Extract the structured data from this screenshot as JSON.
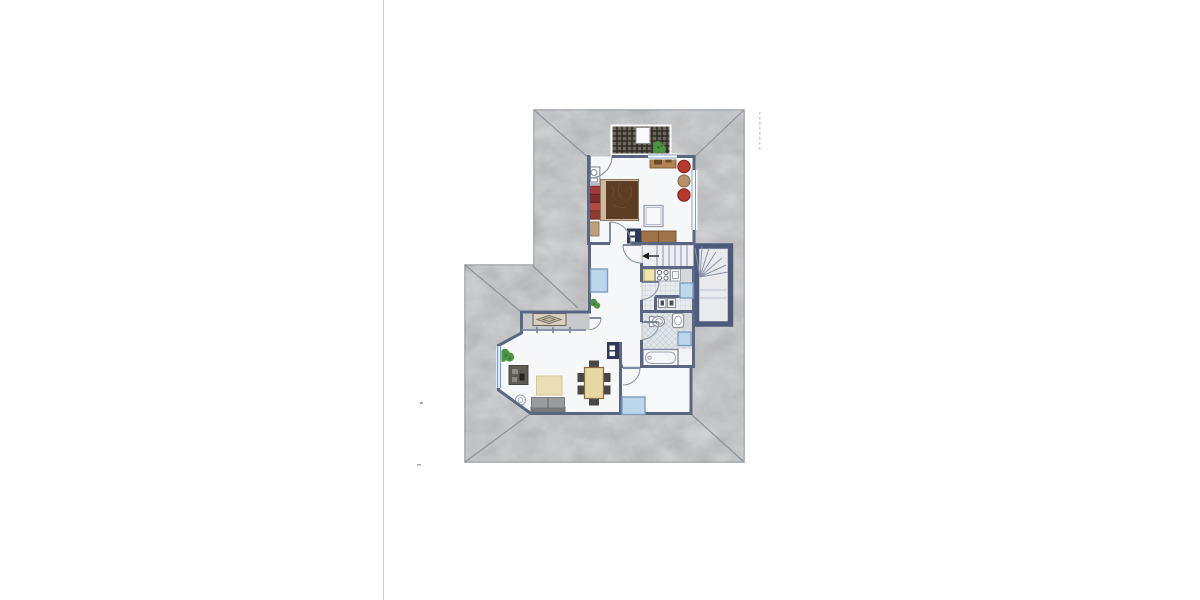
{
  "document": {
    "kind": "architectural floor plan drawing",
    "storey": "attic / roof level with hipped roof",
    "style": "hand-colored watercolor plan on white sheet",
    "visible_text": "none",
    "page_divider": "thin vertical fold line on left third of sheet"
  },
  "colors": {
    "paper": "#ffffff",
    "pageLine": "#cccccc",
    "roof": "#b5b7b9",
    "roofLine": "#8f939b",
    "roofEdge": "#9a9da3",
    "wall": "#5b6683",
    "wallThick": "#4d5a7a",
    "interior": "#f5f7f9",
    "stairFloor": "#edeff2",
    "tile": "#e7ebee",
    "tileLine": "#c3ccd6",
    "bathTile": "#e2e6ea",
    "counterGray": "#d3d8dd",
    "window": "#bcd6ec",
    "windowBorder": "#7f9cc2",
    "glazing": "#7e88a0",
    "arc": "#8a93a8",
    "tread": "#8992a8",
    "fixture": "#8b93a0",
    "balconyFloor": "#c7c9cb",
    "grating": "#6e665a",
    "gratingLine": "#2e2c28",
    "bedBrown": "#5d3d24",
    "bedFrame": "#cdb9a0",
    "wardrobeRed1": "#a33c3a",
    "wardrobeRed2": "#7e2d2d",
    "wardrobeRed3": "#b04a42",
    "wardrobeRed4": "#8e3a32",
    "chairRed": "#b8392e",
    "tableTan": "#b5906a",
    "woodDesk": "#b08354",
    "woodDresser": "#9e7347",
    "counterYellow": "#efe6ac",
    "rug": "#eadfb4",
    "sofa": "#989c9e",
    "sofaBack": "#74787a",
    "dining": "#e7d7a2",
    "chairDark": "#474745",
    "tvCabinet": "#5f5b55",
    "sideboard": "#d6d0c0",
    "plant": "#4c9440",
    "chimney": "#2f3a58",
    "arrowBlack": "#1c1c1c"
  },
  "rooms": [
    {
      "name": "roof terrace",
      "features": [
        "dark wooden grating deck",
        "small white table",
        "potted plant"
      ]
    },
    {
      "name": "bedroom",
      "furniture": [
        "double bed with brown cover",
        "red wardrobe segments",
        "corner washbasin unit",
        "desk",
        "two red round chairs",
        "round tan side table",
        "square table",
        "brown dresser",
        "chimney block"
      ],
      "openings": [
        "terrace door",
        "hall door",
        "window top wall",
        "window right wall"
      ]
    },
    {
      "name": "staircase",
      "features": [
        "winder stair run with fanned treads",
        "direction arrow pointing left",
        "thick-walled stairwell"
      ]
    },
    {
      "name": "kitchen",
      "features": [
        "tiled floor",
        "yellow counter unit",
        "cooktop with four burners",
        "sink unit",
        "roof window"
      ]
    },
    {
      "name": "utility room",
      "features": [
        "two small appliance/sink units"
      ]
    },
    {
      "name": "bathroom",
      "features": [
        "diagonal tiled floor",
        "toilet",
        "washbasin",
        "bathtub",
        "roof window"
      ]
    },
    {
      "name": "hall",
      "features": [
        "roof window",
        "potted plant"
      ]
    },
    {
      "name": "rear room",
      "features": [
        "roof window",
        "door from corridor"
      ]
    },
    {
      "name": "living-dining room",
      "furniture": [
        "sideboard with diamond motif on loggia",
        "TV lowboard",
        "potted plant at dormer window",
        "beige rug",
        "gray two-seat sofa",
        "round side table",
        "dining table",
        "six dark chairs",
        "chimney block"
      ],
      "openings": [
        "dormer bay window",
        "loggia glazing"
      ]
    }
  ],
  "windows": {
    "blue_roof_windows": 4,
    "wall_windows": 3
  },
  "chimneys": 2,
  "page_marks": {
    "fold_line_x": "left third of page",
    "small_specks": 2,
    "faint_tick_column": "right of roof, top"
  }
}
